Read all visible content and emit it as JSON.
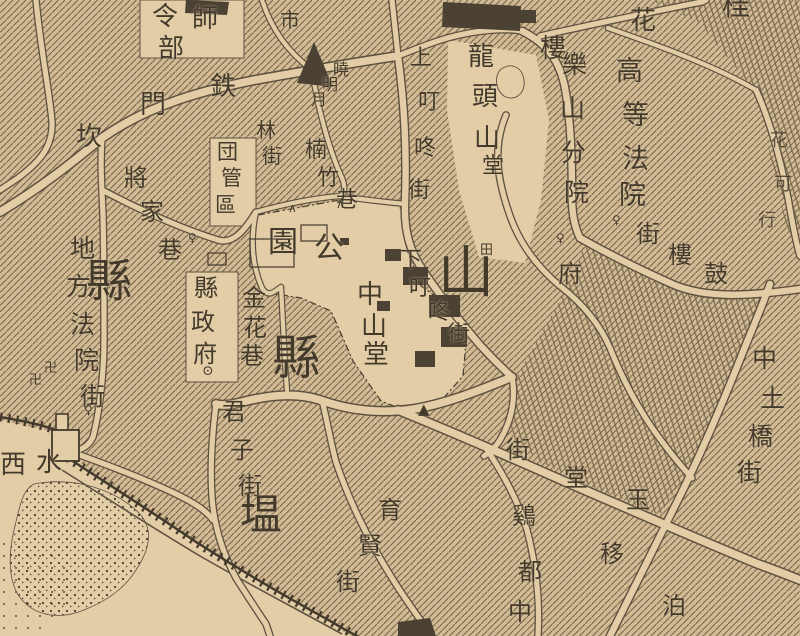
{
  "meta": {
    "kind": "historical-city-map",
    "corner_mark": "桂"
  },
  "colors": {
    "paper": "#d2bb94",
    "paper_light": "#e3cda6",
    "ink": "#433a2c",
    "ink_soft": "#5d5140",
    "hatch_line": "#75654c",
    "dark_fill": "#4c4234"
  },
  "labels": [
    {
      "id": "label-shi-hq",
      "size": 26,
      "chars": [
        [
          "師",
          192,
          6
        ]
      ]
    },
    {
      "id": "label-lingbu",
      "size": 26,
      "chars": [
        [
          "令",
          152,
          4
        ],
        [
          "部",
          158,
          36
        ]
      ]
    },
    {
      "id": "label-shichang",
      "size": 20,
      "chars": [
        [
          "市",
          280,
          10
        ]
      ]
    },
    {
      "id": "label-tiemenkan",
      "size": 26,
      "chars": [
        [
          "鉄",
          210,
          74
        ],
        [
          "門",
          140,
          92
        ],
        [
          "坎",
          76,
          124
        ]
      ]
    },
    {
      "id": "label-xiaomingyue",
      "size": 16,
      "chars": [
        [
          "曉",
          333,
          62
        ],
        [
          "明",
          322,
          77
        ],
        [
          "月",
          311,
          92
        ]
      ]
    },
    {
      "id": "label-linjie",
      "size": 20,
      "chars": [
        [
          "林",
          256,
          120
        ],
        [
          "街",
          262,
          146
        ]
      ]
    },
    {
      "id": "label-tuanguanqu",
      "size": 21,
      "chars": [
        [
          "団",
          217,
          142
        ],
        [
          "管",
          221,
          168
        ],
        [
          "區",
          215,
          195
        ]
      ]
    },
    {
      "id": "label-nanzhuxiang",
      "size": 22,
      "chars": [
        [
          "楠",
          305,
          140
        ],
        [
          "竹",
          317,
          168
        ],
        [
          "巷",
          336,
          190
        ]
      ]
    },
    {
      "id": "label-shangdingdongjie",
      "size": 22,
      "chars": [
        [
          "上",
          410,
          48
        ],
        [
          "叮",
          418,
          92
        ],
        [
          "咚",
          414,
          138
        ],
        [
          "街",
          408,
          180
        ]
      ]
    },
    {
      "id": "label-jiangjiaxiang",
      "size": 24,
      "chars": [
        [
          "將",
          124,
          166
        ],
        [
          "家",
          140,
          200
        ],
        [
          "巷",
          158,
          238
        ]
      ]
    },
    {
      "id": "label-longtoushan",
      "size": 26,
      "chars": [
        [
          "龍",
          468,
          44
        ],
        [
          "頭",
          472,
          84
        ],
        [
          "山",
          474,
          126
        ]
      ]
    },
    {
      "id": "label-tang",
      "size": 22,
      "chars": [
        [
          "堂",
          482,
          156
        ]
      ]
    },
    {
      "id": "label-hua",
      "size": 26,
      "chars": [
        [
          "花",
          630,
          8
        ]
      ]
    },
    {
      "id": "label-lou",
      "size": 26,
      "chars": [
        [
          "樓",
          540,
          36
        ]
      ]
    },
    {
      "id": "label-gui",
      "size": 28,
      "chars": [
        [
          "桂",
          722,
          -8
        ]
      ]
    },
    {
      "id": "label-gaodengfayuan",
      "size": 27,
      "chars": [
        [
          "高",
          616,
          58
        ],
        [
          "等",
          622,
          102
        ],
        [
          "法",
          622,
          146
        ],
        [
          "院",
          619,
          182
        ]
      ]
    },
    {
      "id": "label-leshanfenyuan",
      "size": 25,
      "chars": [
        [
          "樂",
          562,
          52
        ],
        [
          "山",
          560,
          96
        ],
        [
          "分",
          561,
          140
        ],
        [
          "院",
          564,
          180
        ]
      ]
    },
    {
      "id": "label-fu",
      "size": 24,
      "chars": [
        [
          "府",
          558,
          262
        ]
      ]
    },
    {
      "id": "label-guloujie",
      "size": 24,
      "chars": [
        [
          "鼓",
          704,
          262
        ],
        [
          "樓",
          668,
          243
        ],
        [
          "街",
          636,
          222
        ]
      ]
    },
    {
      "id": "label-difangfayuanjie",
      "size": 25,
      "chars": [
        [
          "地",
          70,
          236
        ],
        [
          "方",
          66,
          274
        ],
        [
          "法",
          70,
          312
        ],
        [
          "院",
          74,
          348
        ],
        [
          "街",
          80,
          384
        ]
      ]
    },
    {
      "id": "label-xian-big-left",
      "size": 46,
      "chars": [
        [
          "縣",
          86,
          258
        ]
      ]
    },
    {
      "id": "label-xianzhengfu",
      "size": 24,
      "chars": [
        [
          "縣",
          194,
          276
        ],
        [
          "政",
          191,
          310
        ],
        [
          "府",
          193,
          342
        ]
      ]
    },
    {
      "id": "label-jinhuaxiang",
      "size": 24,
      "chars": [
        [
          "金",
          242,
          286
        ],
        [
          "花",
          243,
          316
        ],
        [
          "巷",
          240,
          344
        ]
      ]
    },
    {
      "id": "label-gongyuan",
      "size": 30,
      "chars": [
        [
          "園",
          268,
          228
        ],
        [
          "公",
          314,
          234
        ]
      ]
    },
    {
      "id": "label-xian-big-mid",
      "size": 48,
      "chars": [
        [
          "縣",
          272,
          334
        ]
      ]
    },
    {
      "id": "label-zhongshantang",
      "size": 26,
      "chars": [
        [
          "中",
          357,
          282
        ],
        [
          "山",
          361,
          314
        ],
        [
          "堂",
          363,
          342
        ]
      ]
    },
    {
      "id": "label-shan-big",
      "size": 56,
      "chars": [
        [
          "山",
          438,
          246
        ]
      ]
    },
    {
      "id": "label-xiadingdongjie",
      "size": 22,
      "chars": [
        [
          "下",
          400,
          250
        ],
        [
          "叮",
          409,
          278
        ],
        [
          "咚",
          428,
          302
        ],
        [
          "街",
          448,
          324
        ]
      ]
    },
    {
      "id": "label-zhongtuqiaojie",
      "size": 25,
      "chars": [
        [
          "中",
          752,
          346
        ],
        [
          "土",
          760,
          386
        ],
        [
          "橋",
          748,
          424
        ],
        [
          "街",
          737,
          460
        ]
      ]
    },
    {
      "id": "label-yutangjie",
      "size": 24,
      "chars": [
        [
          "玉",
          626,
          488
        ],
        [
          "堂",
          564,
          466
        ],
        [
          "街",
          506,
          438
        ]
      ]
    },
    {
      "id": "label-ji",
      "size": 24,
      "chars": [
        [
          "鷄",
          512,
          504
        ]
      ]
    },
    {
      "id": "label-duzhong",
      "size": 24,
      "chars": [
        [
          "都",
          518,
          560
        ],
        [
          "中",
          508,
          600
        ]
      ]
    },
    {
      "id": "label-yi",
      "size": 24,
      "chars": [
        [
          "移",
          600,
          542
        ]
      ]
    },
    {
      "id": "label-bo",
      "size": 24,
      "chars": [
        [
          "泊",
          662,
          594
        ]
      ]
    },
    {
      "id": "label-right-edge",
      "size": 18,
      "opacity": 0.85,
      "chars": [
        [
          "花",
          770,
          132
        ],
        [
          "可",
          774,
          176
        ],
        [
          "行",
          758,
          212
        ]
      ]
    },
    {
      "id": "label-junzijie",
      "size": 24,
      "chars": [
        [
          "君",
          222,
          400
        ],
        [
          "子",
          230,
          438
        ],
        [
          "街",
          238,
          474
        ]
      ]
    },
    {
      "id": "label-wen-big",
      "size": 42,
      "chars": [
        [
          "塭",
          240,
          494
        ]
      ]
    },
    {
      "id": "label-yuxianjie",
      "size": 24,
      "chars": [
        [
          "育",
          378,
          498
        ],
        [
          "賢",
          358,
          534
        ],
        [
          "街",
          336,
          570
        ]
      ]
    },
    {
      "id": "label-shuiximen",
      "size": 26,
      "chars": [
        [
          "西",
          0,
          452
        ],
        [
          "水",
          36,
          450
        ]
      ]
    },
    {
      "id": "sym-swastika-1",
      "size": 13,
      "chars": [
        [
          "卍",
          44,
          362
        ]
      ]
    },
    {
      "id": "sym-swastika-2",
      "size": 13,
      "chars": [
        [
          "卍",
          29,
          374
        ]
      ]
    },
    {
      "id": "sym-gov-circle",
      "size": 14,
      "chars": [
        [
          "⊙",
          202,
          364
        ]
      ]
    },
    {
      "id": "sym-field",
      "size": 13,
      "chars": [
        [
          "田",
          480,
          244
        ]
      ]
    },
    {
      "id": "sym-triangle-mark",
      "size": 15,
      "chars": [
        [
          "▲",
          418,
          402
        ]
      ]
    },
    {
      "id": "sym-shrine-1",
      "size": 12,
      "chars": [
        [
          "♀",
          612,
          214
        ]
      ]
    },
    {
      "id": "sym-shrine-2",
      "size": 12,
      "chars": [
        [
          "♀",
          556,
          232
        ]
      ]
    },
    {
      "id": "sym-shrine-3",
      "size": 12,
      "chars": [
        [
          "♀",
          84,
          404
        ]
      ]
    },
    {
      "id": "sym-shrine-4",
      "size": 12,
      "chars": [
        [
          "♀",
          188,
          232
        ]
      ]
    },
    {
      "id": "sym-caret-1",
      "size": 12,
      "chars": [
        [
          "∧",
          288,
          202
        ]
      ]
    },
    {
      "id": "sym-caret-2",
      "size": 12,
      "chars": [
        [
          "∧",
          336,
          198
        ]
      ]
    }
  ]
}
